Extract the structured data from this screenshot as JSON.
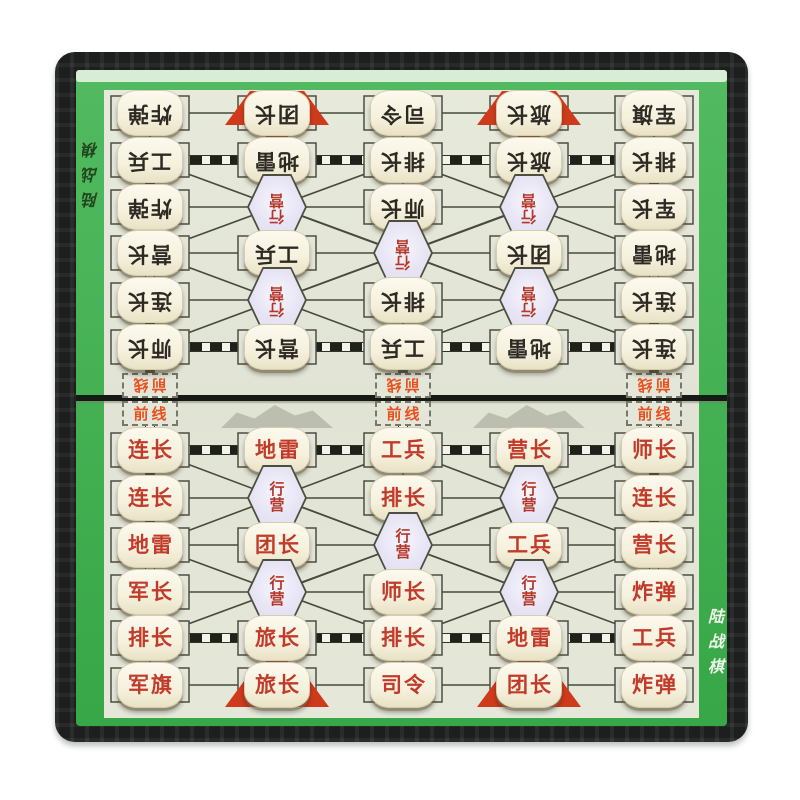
{
  "labels": {
    "top_left": "陆战棋",
    "bottom_right": "陆战棋"
  },
  "frontline_label": "前线",
  "camp_label": "行营",
  "colors": {
    "board_green": "#3ab14b",
    "play_area": "#e3e6d8",
    "frame_black": "#1d1f1e",
    "piece_text_bottom_red": "#c23b2a",
    "piece_text_top_black": "#2d2a24",
    "camp_fill": "#e6e4f4",
    "camp_text_red": "#b4382a",
    "frontline_text_orange": "#e8511d",
    "hq_marker_red": "#cf3a1c",
    "piece_tile_ivory": "#f6f1dd"
  },
  "top_half_pieces": [
    [
      "炸弹",
      "团长",
      "司令",
      "旅长",
      "军旗"
    ],
    [
      "工兵",
      "地雷",
      "排长",
      "旅长",
      "排长"
    ],
    [
      "炸弹",
      null,
      "师长",
      null,
      "军长"
    ],
    [
      "营长",
      "工兵",
      null,
      "团长",
      "地雷"
    ],
    [
      "连长",
      null,
      "排长",
      null,
      "连长"
    ],
    [
      "师长",
      "营长",
      "工兵",
      "地雷",
      "连长"
    ]
  ],
  "bottom_half_pieces": [
    [
      "连长",
      "地雷",
      "工兵",
      "营长",
      "师长"
    ],
    [
      "连长",
      null,
      "排长",
      null,
      "连长"
    ],
    [
      "地雷",
      "团长",
      null,
      "工兵",
      "营长"
    ],
    [
      "军长",
      null,
      "师长",
      null,
      "炸弹"
    ],
    [
      "排长",
      "旅长",
      "排长",
      "地雷",
      "工兵"
    ],
    [
      "军旗",
      "旅长",
      "司令",
      "团长",
      "炸弹"
    ]
  ],
  "hq_column_indexes": [
    1,
    3
  ]
}
